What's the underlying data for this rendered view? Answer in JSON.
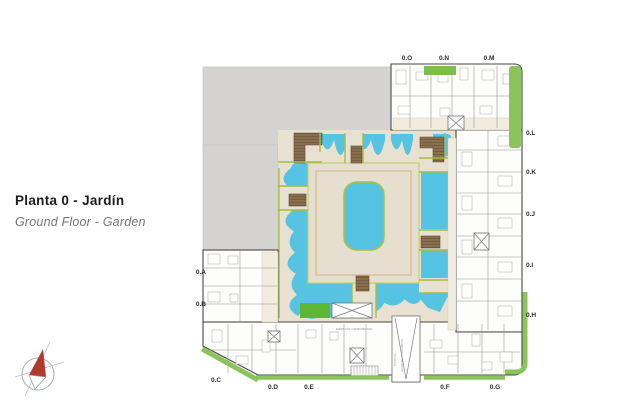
{
  "title": {
    "main": "Planta 0 - Jardín",
    "subtitle": "Ground Floor - Garden"
  },
  "plan": {
    "unit_labels": [
      {
        "id": "0.O"
      },
      {
        "id": "0.N"
      },
      {
        "id": "0.M"
      },
      {
        "id": "0.L"
      },
      {
        "id": "0.K"
      },
      {
        "id": "0.J"
      },
      {
        "id": "0.I"
      },
      {
        "id": "0.H"
      },
      {
        "id": "0.G"
      },
      {
        "id": "0.F"
      },
      {
        "id": "0.E"
      },
      {
        "id": "0.D"
      },
      {
        "id": "0.C"
      },
      {
        "id": "0.B"
      },
      {
        "id": "0.A"
      }
    ],
    "annotations": {
      "coworking": "ESPACIO COWORKING",
      "portal": "PORTAL",
      "access": "ACCESO VIVIENDAS"
    },
    "colors": {
      "water": "#57c3e2",
      "pool_edge": "#a8c23f",
      "hedge": "#a6bc3f",
      "lawn": "#5eb733",
      "landscape_strip": "#8cc45c",
      "patio_green": "#7bbf4a",
      "courtyard_paving": "#e8e1d2",
      "deck_paving": "#e6dfcf",
      "wood_deck": "#8a6f4e",
      "existing_building": "#d4d3d1",
      "compass_north": "#b03a2e"
    }
  }
}
